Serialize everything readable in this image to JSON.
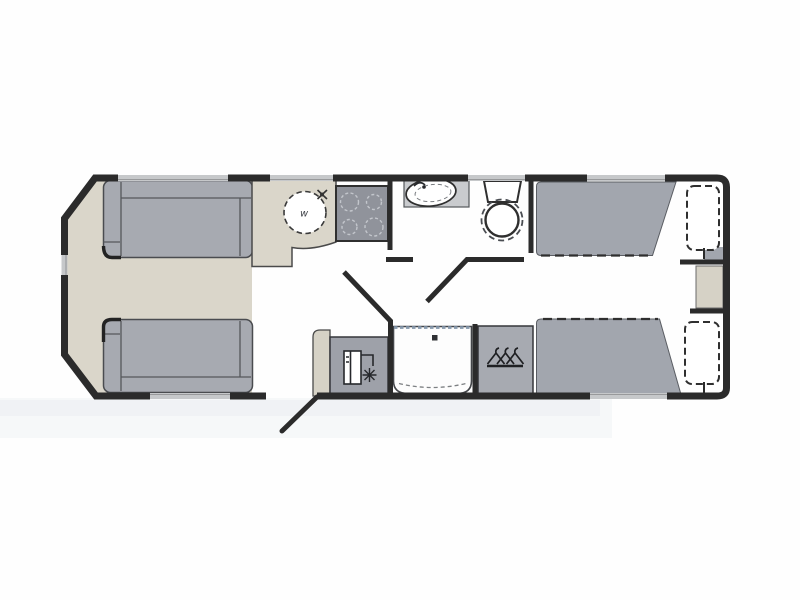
{
  "figure": {
    "type": "caravan-floorplan",
    "sink_marking": "w",
    "colors": {
      "wall": "#2b2b2b",
      "floor_beige": "#dad6ca",
      "furniture_gray": "#a7aab1",
      "bed_gray": "#a2a6ae",
      "hob_gray": "#90939b",
      "window_gray": "#c6c8ca",
      "counter_gray": "#c9cbce",
      "cabinet_beige": "#d6d2c6",
      "shower_glass": "#7f93a8",
      "white": "#ffffff"
    },
    "features": [
      "front-lounge-sofa-top",
      "front-lounge-sofa-bottom",
      "kitchen-worktop",
      "kitchen-sink",
      "kitchen-hob",
      "washroom-basin",
      "washroom-toilet",
      "entrance-door",
      "fridge-freezer",
      "shower-cubicle",
      "wardrobe",
      "rear-twin-bed-top",
      "rear-twin-bed-bottom",
      "pillow-top",
      "pillow-bottom",
      "bedside-cabinet"
    ]
  }
}
